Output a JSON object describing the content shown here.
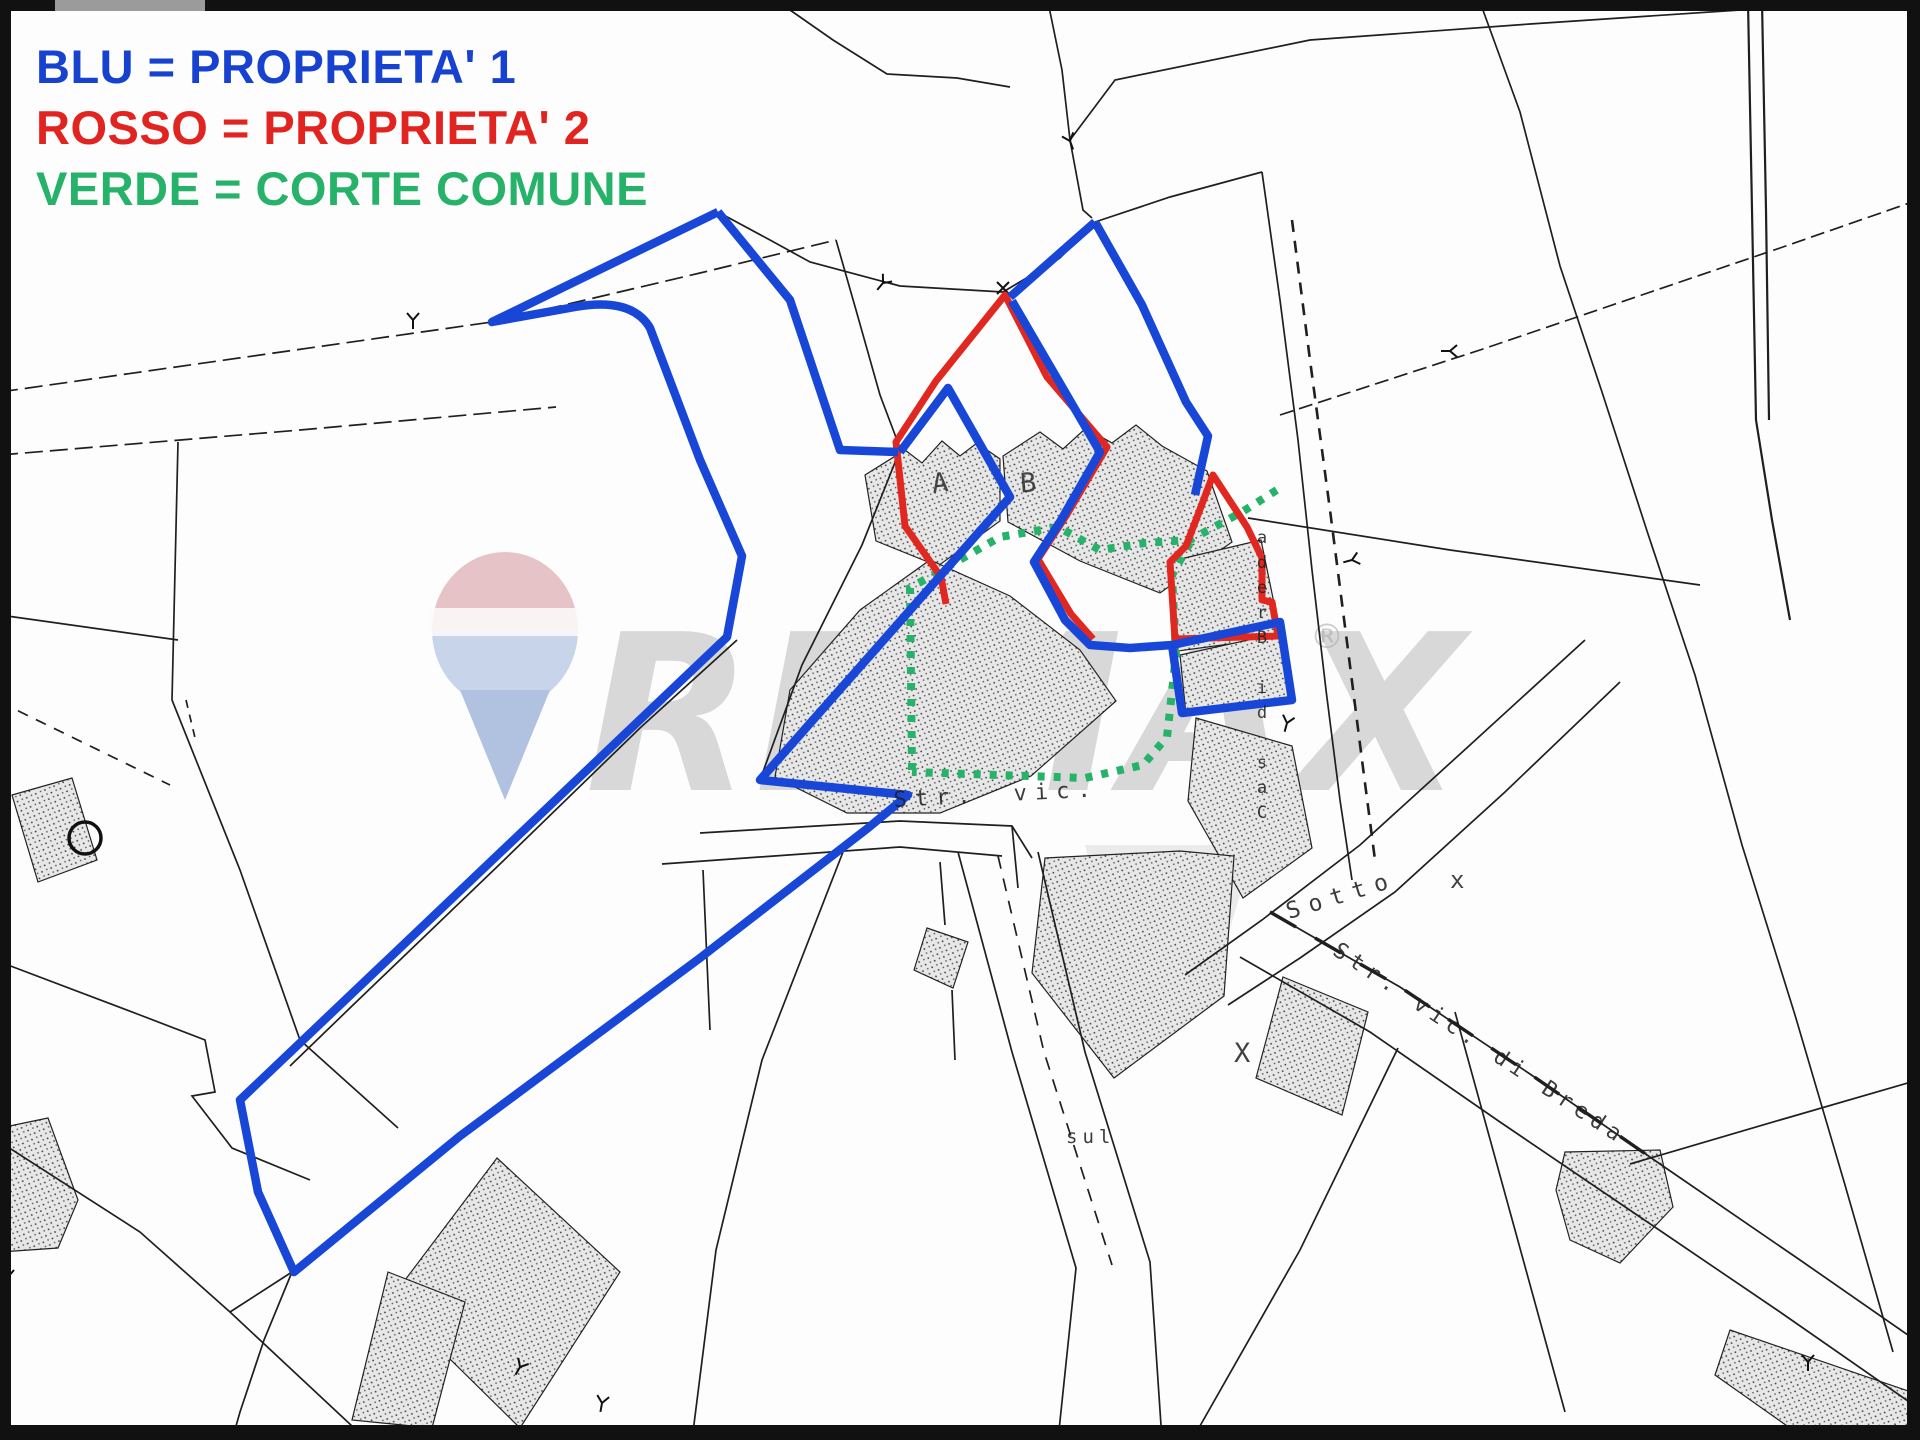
{
  "legend": {
    "items": [
      {
        "label": "BLU = PROPRIETA' 1",
        "color_name": "blu",
        "color": "#1742d0"
      },
      {
        "label": "ROSSO = PROPRIETA' 2",
        "color_name": "rosso",
        "color": "#e22421"
      },
      {
        "label": "VERDE = CORTE COMUNE",
        "color_name": "verde",
        "color": "#27b26a"
      }
    ]
  },
  "map": {
    "type": "cadastral-parcel-map",
    "road_labels": {
      "str_vic": "Str. vic.",
      "sotto": "Sotto",
      "str_vic_di_breda": "Str. vic. di Breda",
      "sul": "sul",
      "cas_di_breda_vertical": "Cas di Breda"
    },
    "building_labels": {
      "a": "A",
      "b": "B"
    },
    "surveyor_marks": {
      "x1": "x",
      "x2": "X"
    }
  },
  "watermark": {
    "brand": "REMAX",
    "registered_mark": "®"
  },
  "colors": {
    "property1_blue": "#1847d8",
    "property2_red": "#e02820",
    "corte_comune_green": "#27b26a",
    "legend_blue": "#1742d0",
    "legend_red": "#e22421",
    "legend_green": "#27b26a",
    "map_line_black": "#1f1f1f",
    "watermark_gray": "#b5b5b5",
    "building_fill": "#e7e7e7"
  }
}
